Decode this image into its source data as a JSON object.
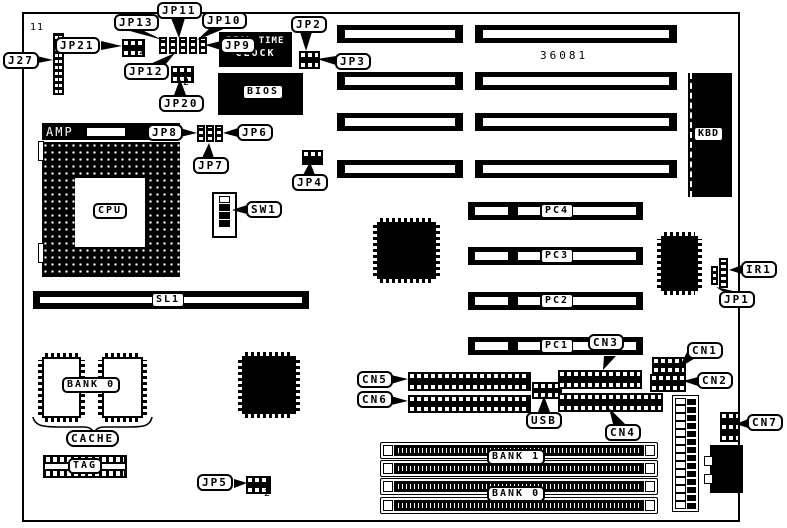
{
  "part_number": "36081",
  "chips": {
    "rtc_line1": "REAL TIME",
    "rtc_line2": "CLOCK",
    "bios": "BIOS",
    "amp": "AMP",
    "cpu": "CPU",
    "kbd": "KBD"
  },
  "slots": {
    "sl1": "SL1",
    "pc4": "PC4",
    "pc3": "PC3",
    "pc2": "PC2",
    "pc1": "PC1",
    "bank1": "BANK 1",
    "bank0_simm": "BANK 0"
  },
  "cache": {
    "bank0": "BANK 0",
    "cache": "CACHE",
    "tag": "TAG"
  },
  "callouts": {
    "j27": "J27",
    "jp21": "JP21",
    "jp13": "JP13",
    "jp11": "JP11",
    "jp10": "JP10",
    "jp9": "JP9",
    "jp12": "JP12",
    "jp20": "JP20",
    "jp2": "JP2",
    "jp3": "JP3",
    "jp8": "JP8",
    "jp6": "JP6",
    "jp7": "JP7",
    "jp4": "JP4",
    "sw1": "SW1",
    "ir1": "IR1",
    "jp1": "JP1",
    "cn1": "CN1",
    "cn2": "CN2",
    "cn3": "CN3",
    "cn4": "CN4",
    "cn5": "CN5",
    "cn6": "CN6",
    "cn7": "CN7",
    "usb": "USB",
    "jp5": "JP5"
  },
  "annotations": {
    "j27_pincount": "11",
    "jp21_pin2": "2",
    "jp20_pin2": "2",
    "jp5_pin2": "2"
  }
}
